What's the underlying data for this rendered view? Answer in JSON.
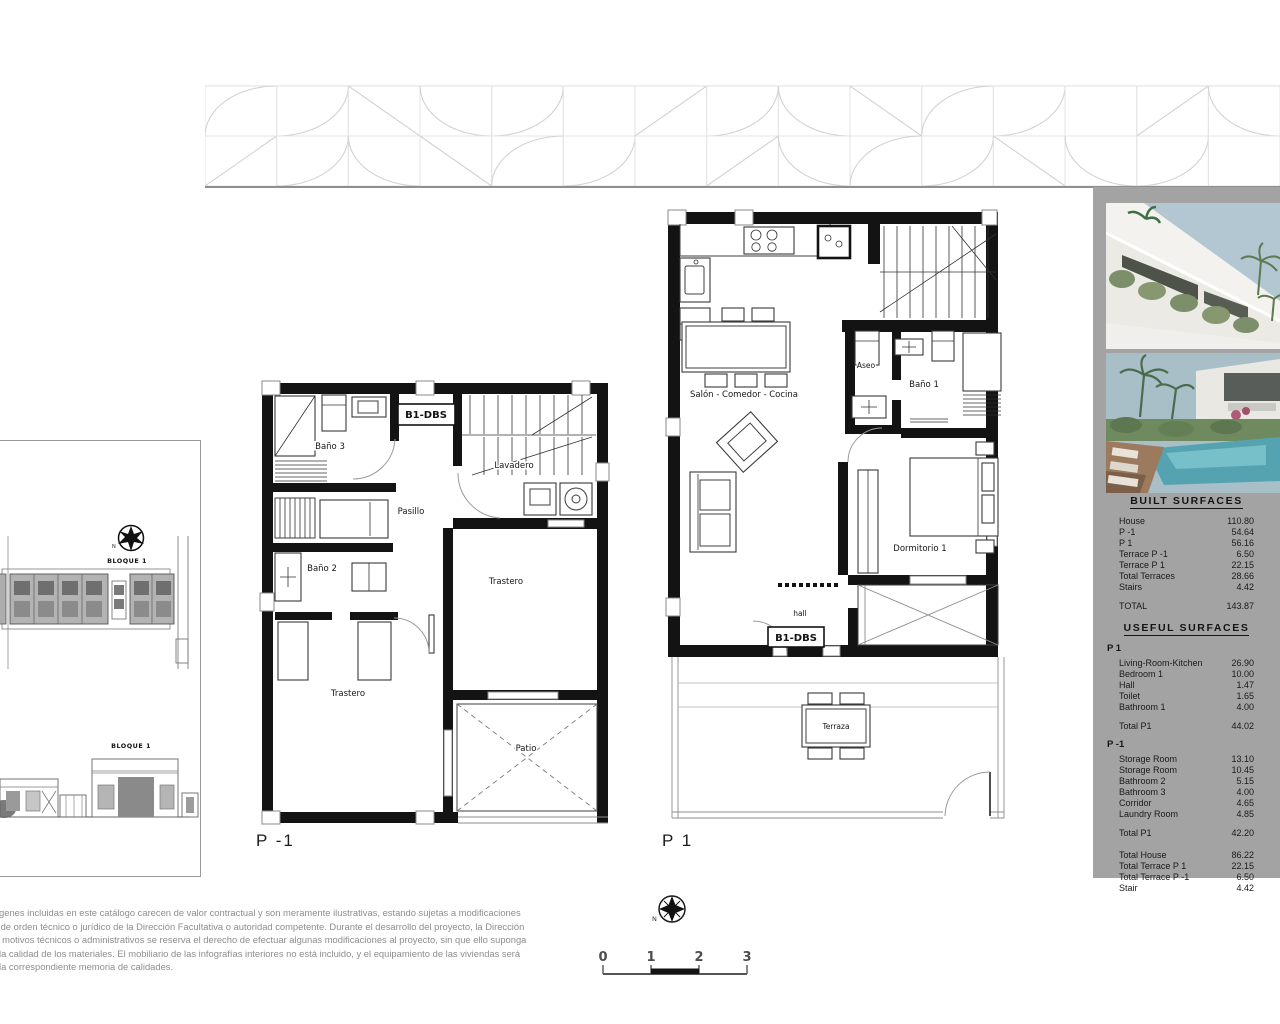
{
  "sidebar": {
    "built": {
      "title": "BUILT SURFACES",
      "rows": [
        {
          "label": "House",
          "value": "110.80"
        },
        {
          "label": "P -1",
          "value": "54.64"
        },
        {
          "label": "P 1",
          "value": "56.16"
        },
        {
          "label": "Terrace  P -1",
          "value": "6.50"
        },
        {
          "label": "Terrace  P 1",
          "value": "22.15"
        },
        {
          "label": "Total Terraces",
          "value": "28.66"
        },
        {
          "label": "Stairs",
          "value": "4.42"
        }
      ],
      "total_label": "TOTAL",
      "total_value": "143.87"
    },
    "useful": {
      "title": "USEFUL SURFACES",
      "p1_header": "P 1",
      "p1_rows": [
        {
          "label": "Living-Room-Kitchen",
          "value": "26.90"
        },
        {
          "label": "Bedroom 1",
          "value": "10.00"
        },
        {
          "label": "Hall",
          "value": "1.47"
        },
        {
          "label": "Toilet",
          "value": "1.65"
        },
        {
          "label": "Bathroom 1",
          "value": "4.00"
        }
      ],
      "p1_total_label": "Total  P1",
      "p1_total_value": "44.02",
      "pm1_header": "P -1",
      "pm1_rows": [
        {
          "label": "Storage Room",
          "value": "13.10"
        },
        {
          "label": "Storage Room",
          "value": "10.45"
        },
        {
          "label": "Bathroom 2",
          "value": "5.15"
        },
        {
          "label": "Bathroom 3",
          "value": "4.00"
        },
        {
          "label": "Corridor",
          "value": "4.65"
        },
        {
          "label": "Laundry Room",
          "value": "4.85"
        }
      ],
      "pm1_total_label": "Total  P1",
      "pm1_total_value": "42.20",
      "summary_rows": [
        {
          "label": "Total House",
          "value": "86.22"
        },
        {
          "label": "Total Terrace  P 1",
          "value": "22.15"
        },
        {
          "label": "Total Terrace  P -1",
          "value": "6.50"
        },
        {
          "label": "Stair",
          "value": "4.42"
        }
      ]
    }
  },
  "plans": {
    "pm1": {
      "label": "P -1",
      "tag": "B1-DBS",
      "rooms": {
        "bano3": "Baño 3",
        "lavadero": "Lavadero",
        "pasillo": "Pasillo",
        "bano2": "Baño 2",
        "trastero_right": "Trastero",
        "trastero_left": "Trastero",
        "patio": "Patio"
      }
    },
    "p1": {
      "label": "P 1",
      "tag": "B1-DBS",
      "rooms": {
        "salon": "Salón - Comedor - Cocina",
        "aseo": "Aseo",
        "bano1": "Baño 1",
        "dormitorio": "Dormitorio 1",
        "hall": "hall",
        "terraza": "Terraza"
      }
    }
  },
  "keyplan": {
    "bloque_top": "BLOQUE 1",
    "bloque_bottom": "BLOQUE 1",
    "north": "N"
  },
  "compass": {
    "north": "N"
  },
  "scalebar": {
    "ticks": [
      "0",
      "1",
      "2",
      "3"
    ]
  },
  "disclaimer": {
    "lines": [
      "mágenes incluidas en este catálogo carecen de valor contractual y son meramente ilustrativas, estando sujetas a modificaciones",
      "las de orden técnico o jurídico de la Dirección Facultativa o autoridad competente. Durante el desarrollo del proyecto, la Dirección",
      "por motivos técnicos o administrativos se reserva el derecho de efectuar algunas modificaciones al proyecto, sin que ello suponga",
      "en la calidad de los materiales. El mobiliario de las infografías interiores no está incluido, y el equipamiento de las viviendas será",
      "en la correspondiente memoria de calidades."
    ]
  }
}
